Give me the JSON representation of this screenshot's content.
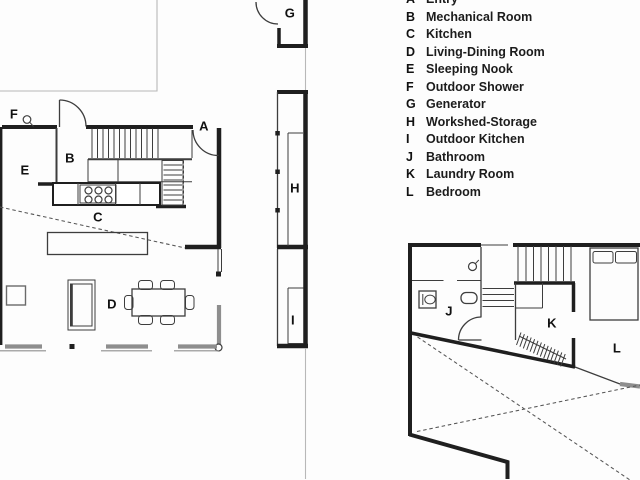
{
  "title": "House floor plan with room legend",
  "colors": {
    "background": "#fdfdfd",
    "wall": "#1f1f1f",
    "line": "#3d3d3d",
    "thin_gray": "#b8b8b8",
    "window_gray": "#8e8e8e",
    "dash": "#555555",
    "label": "#111111"
  },
  "legend": {
    "items": [
      {
        "key": "A",
        "label": "Entry"
      },
      {
        "key": "B",
        "label": "Mechanical Room"
      },
      {
        "key": "C",
        "label": "Kitchen"
      },
      {
        "key": "D",
        "label": "Living-Dining Room"
      },
      {
        "key": "E",
        "label": "Sleeping Nook"
      },
      {
        "key": "F",
        "label": "Outdoor Shower"
      },
      {
        "key": "G",
        "label": "Generator"
      },
      {
        "key": "H",
        "label": "Workshed-Storage"
      },
      {
        "key": "I",
        "label": "Outdoor Kitchen"
      },
      {
        "key": "J",
        "label": "Bathroom"
      },
      {
        "key": "K",
        "label": "Laundry Room"
      },
      {
        "key": "L",
        "label": "Bedroom"
      }
    ]
  },
  "plan_labels": {
    "A": "A",
    "B": "B",
    "C": "C",
    "D": "D",
    "E": "E",
    "F": "F",
    "G": "G",
    "H": "H",
    "I": "I",
    "J": "J",
    "K": "K",
    "L": "L"
  }
}
